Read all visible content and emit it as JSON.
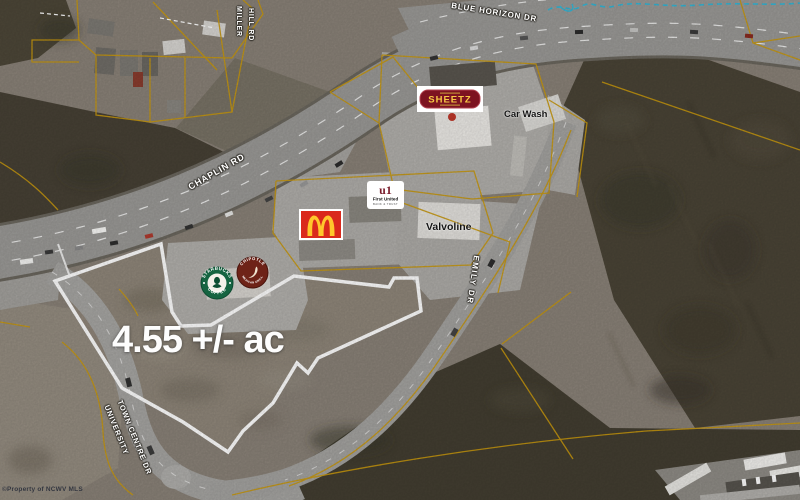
{
  "map": {
    "acreage": "4.55 +/- ac",
    "watermark": "©Property of NCWV MLS",
    "roads": {
      "blue_horizon": "BLUE HORIZON DR",
      "miller_hill_1": "MILLER",
      "miller_hill_2": "HILL RD",
      "chaplin": "CHAPLIN RD",
      "emily": "EMILY DR",
      "university": "UNIVERSITY",
      "town_centre": "TOWN CENTRE DR"
    },
    "places": {
      "car_wash": "Car Wash",
      "valvoline": "Valvoline"
    },
    "logos": {
      "sheetz": "SHEETZ",
      "first_united_mark": "u1",
      "first_united_name": "First United",
      "first_united_sub": "BANK & TRUST",
      "starbucks_top": "STARBUCKS",
      "starbucks_bottom": "COFFEE",
      "chipotle_top": "CHIPOTLE",
      "chipotle_bottom": "MEXICAN GRILL"
    },
    "colors": {
      "parcel_line": "#c9990f",
      "boundary": "#ffffff",
      "stream_line": "#35b6d6",
      "mcdonalds_red": "#DA291C",
      "mcdonalds_yellow": "#FFC72C",
      "sheetz_red": "#7d1320",
      "sheetz_gold": "#f7c844",
      "starbucks_green": "#156441",
      "chipotle_maroon": "#6e2318",
      "first_united_red": "#7a1d2c"
    }
  }
}
